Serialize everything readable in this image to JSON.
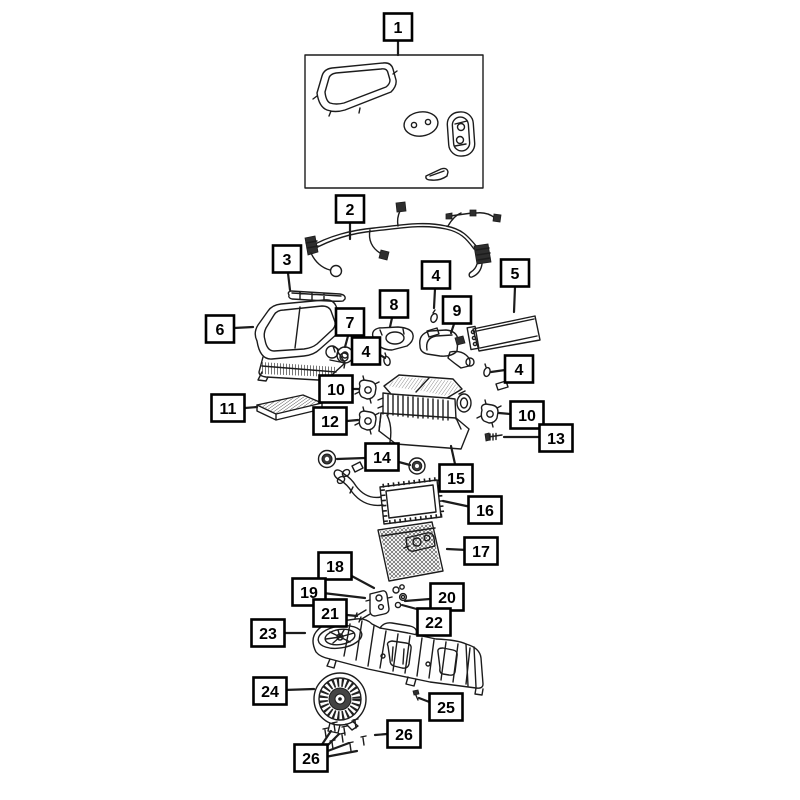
{
  "diagram": {
    "type": "exploded-parts-diagram",
    "subject": "HVAC heater and air-conditioning unit exploded view with numbered callouts",
    "canvas": {
      "width": 800,
      "height": 800,
      "background": "#ffffff"
    },
    "style": {
      "line_color": "#1c1c1c",
      "callout_border": "#000000",
      "callout_fill": "#ffffff",
      "callout_text": "#000000"
    },
    "callouts": [
      {
        "name": "callout-1",
        "label": "1",
        "x": 398,
        "y": 27,
        "leaders": [
          [
            398,
            41,
            398,
            55
          ]
        ]
      },
      {
        "name": "callout-2",
        "label": "2",
        "x": 350,
        "y": 209,
        "leaders": [
          [
            350,
            223,
            350,
            239
          ]
        ]
      },
      {
        "name": "callout-3",
        "label": "3",
        "x": 287,
        "y": 259,
        "leaders": [
          [
            288,
            273,
            290,
            290
          ]
        ]
      },
      {
        "name": "callout-4-top",
        "label": "4",
        "x": 436,
        "y": 275,
        "leaders": [
          [
            435,
            289,
            434,
            308
          ]
        ]
      },
      {
        "name": "callout-5",
        "label": "5",
        "x": 515,
        "y": 273,
        "leaders": [
          [
            515,
            287,
            514,
            312
          ]
        ]
      },
      {
        "name": "callout-6",
        "label": "6",
        "x": 220,
        "y": 329,
        "leaders": [
          [
            234,
            328,
            253,
            327
          ]
        ]
      },
      {
        "name": "callout-7",
        "label": "7",
        "x": 350,
        "y": 322,
        "leaders": [
          [
            348,
            336,
            345,
            347
          ]
        ]
      },
      {
        "name": "callout-8",
        "label": "8",
        "x": 394,
        "y": 304,
        "leaders": [
          [
            392,
            318,
            390,
            327
          ]
        ]
      },
      {
        "name": "callout-9",
        "label": "9",
        "x": 457,
        "y": 310,
        "leaders": [
          [
            454,
            324,
            451,
            333
          ]
        ]
      },
      {
        "name": "callout-4-mid",
        "label": "4",
        "x": 366,
        "y": 351,
        "leaders": [
          [
            377,
            353,
            385,
            358
          ]
        ]
      },
      {
        "name": "callout-10-left",
        "label": "10",
        "x": 336,
        "y": 389,
        "leaders": [
          [
            353,
            389,
            359,
            389
          ]
        ]
      },
      {
        "name": "callout-11",
        "label": "11",
        "x": 228,
        "y": 408,
        "leaders": [
          [
            245,
            408,
            257,
            407
          ]
        ]
      },
      {
        "name": "callout-12",
        "label": "12",
        "x": 330,
        "y": 421,
        "leaders": [
          [
            347,
            421,
            358,
            420
          ]
        ]
      },
      {
        "name": "callout-4-right",
        "label": "4",
        "x": 519,
        "y": 369,
        "leaders": [
          [
            505,
            370,
            491,
            372
          ]
        ]
      },
      {
        "name": "callout-10-right",
        "label": "10",
        "x": 527,
        "y": 415,
        "leaders": [
          [
            510,
            414,
            499,
            413
          ]
        ]
      },
      {
        "name": "callout-13",
        "label": "13",
        "x": 556,
        "y": 438,
        "leaders": [
          [
            539,
            437,
            504,
            437
          ]
        ]
      },
      {
        "name": "callout-14",
        "label": "14",
        "x": 382,
        "y": 457,
        "leaders": [
          [
            365,
            458,
            337,
            459
          ],
          [
            395,
            461,
            410,
            465
          ]
        ]
      },
      {
        "name": "callout-15",
        "label": "15",
        "x": 456,
        "y": 478,
        "leaders": [
          [
            455,
            464,
            451,
            446
          ]
        ]
      },
      {
        "name": "callout-16",
        "label": "16",
        "x": 485,
        "y": 510,
        "leaders": [
          [
            471,
            507,
            443,
            501
          ]
        ]
      },
      {
        "name": "callout-17",
        "label": "17",
        "x": 481,
        "y": 551,
        "leaders": [
          [
            467,
            550,
            447,
            549
          ]
        ]
      },
      {
        "name": "callout-18",
        "label": "18",
        "x": 335,
        "y": 566,
        "leaders": [
          [
            348,
            574,
            374,
            588
          ]
        ]
      },
      {
        "name": "callout-19",
        "label": "19",
        "x": 309,
        "y": 592,
        "leaders": [
          [
            323,
            593,
            365,
            598
          ]
        ]
      },
      {
        "name": "callout-20",
        "label": "20",
        "x": 447,
        "y": 597,
        "leaders": [
          [
            430,
            599,
            405,
            601
          ]
        ]
      },
      {
        "name": "callout-21",
        "label": "21",
        "x": 330,
        "y": 613,
        "leaders": [
          [
            347,
            615,
            357,
            616
          ]
        ]
      },
      {
        "name": "callout-22",
        "label": "22",
        "x": 434,
        "y": 622,
        "leaders": [
          [
            424,
            611,
            402,
            605
          ]
        ]
      },
      {
        "name": "callout-23",
        "label": "23",
        "x": 268,
        "y": 633,
        "leaders": [
          [
            282,
            633,
            305,
            633
          ]
        ]
      },
      {
        "name": "callout-24",
        "label": "24",
        "x": 270,
        "y": 691,
        "leaders": [
          [
            284,
            690,
            314,
            689
          ]
        ]
      },
      {
        "name": "callout-25",
        "label": "25",
        "x": 446,
        "y": 707,
        "leaders": [
          [
            432,
            703,
            419,
            698
          ]
        ]
      },
      {
        "name": "callout-26-right",
        "label": "26",
        "x": 404,
        "y": 734,
        "leaders": [
          [
            387,
            734,
            375,
            735
          ]
        ]
      },
      {
        "name": "callout-26-left",
        "label": "26",
        "x": 311,
        "y": 758,
        "leaders": [
          [
            325,
            748,
            339,
            734
          ],
          [
            325,
            752,
            349,
            743
          ],
          [
            325,
            757,
            357,
            751
          ],
          [
            321,
            746,
            331,
            731
          ]
        ]
      }
    ]
  }
}
